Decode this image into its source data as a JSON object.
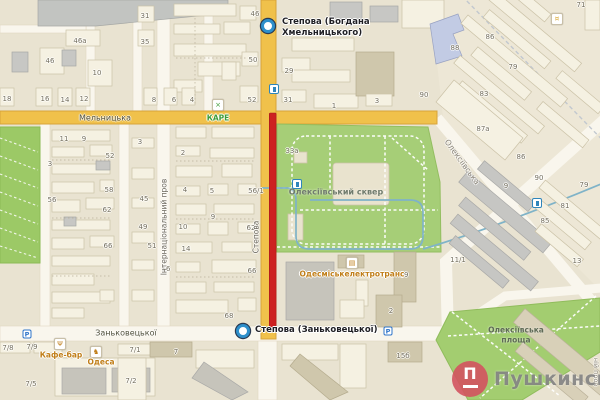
{
  "map": {
    "width": 600,
    "height": 400
  },
  "markers": {
    "top": {
      "label_line1": "Степова (Богдана",
      "label_line2": "Хмельницького)",
      "x": 268,
      "y": 26
    },
    "bottom": {
      "label": "Степова (Заньковецької)",
      "x": 243,
      "y": 331
    }
  },
  "street_labels": [
    {
      "text": "Мельницька",
      "x": 105,
      "y": 118,
      "rot": 0,
      "size": 8,
      "color": "#50503C"
    },
    {
      "text": "Заньковецької",
      "x": 126,
      "y": 333,
      "rot": 0,
      "size": 8,
      "color": "#50503C"
    },
    {
      "text": "Степова",
      "x": 256,
      "y": 237,
      "rot": -90,
      "size": 7.5,
      "color": "#6B675C"
    },
    {
      "text": "Інтернаціональний пров",
      "x": 164,
      "y": 227,
      "rot": -90,
      "size": 7.5,
      "color": "#6B675C"
    },
    {
      "text": "Олексіївська",
      "x": 462,
      "y": 162,
      "rot": 54,
      "size": 8,
      "color": "#8A8478"
    },
    {
      "text": "ній пров",
      "x": 596,
      "y": 372,
      "rot": 90,
      "size": 6.5,
      "color": "#8A8478"
    }
  ],
  "area_labels": [
    {
      "text": "Олексіївський сквер",
      "x": 336,
      "y": 192,
      "size": 8,
      "color": "#6F7B6C"
    },
    {
      "text": "Олексіївська",
      "x": 516,
      "y": 330,
      "size": 7.5,
      "color": "#5E6A55"
    },
    {
      "text": "площа",
      "x": 516,
      "y": 340,
      "size": 7.5,
      "color": "#5E6A55"
    }
  ],
  "pois": [
    {
      "label": "КАРЕ",
      "x": 218,
      "y": 118,
      "icon": "kare",
      "icon_x": 218,
      "icon_y": 105,
      "color": "#3E9C38"
    },
    {
      "label": "Кафе-бар",
      "x": 61,
      "y": 355,
      "icon": "fork",
      "icon_x": 60,
      "icon_y": 344,
      "color": "#C07E18"
    },
    {
      "label": "Одеса",
      "x": 101,
      "y": 362,
      "icon": "horse",
      "icon_x": 96,
      "icon_y": 352,
      "color": "#C07E18"
    },
    {
      "label": "Одесміськелектротранс",
      "x": 352,
      "y": 274,
      "icon": "building",
      "icon_x": 352,
      "icon_y": 263,
      "color": "#C07E18"
    },
    {
      "label": "",
      "x": 557,
      "y": 19,
      "icon": "shop",
      "icon_x": 557,
      "icon_y": 19,
      "color": "#D9A62E"
    }
  ],
  "house_numbers": [
    [
      "46а",
      80,
      41
    ],
    [
      "46",
      50,
      61
    ],
    [
      "10",
      97,
      73
    ],
    [
      "31",
      145,
      16
    ],
    [
      "35",
      145,
      42
    ],
    [
      "18",
      7,
      99
    ],
    [
      "16",
      45,
      99
    ],
    [
      "14",
      65,
      100
    ],
    [
      "12",
      84,
      99
    ],
    [
      "46",
      255,
      14
    ],
    [
      "50",
      253,
      60
    ],
    [
      "8",
      154,
      100
    ],
    [
      "6",
      174,
      100
    ],
    [
      "4",
      192,
      100
    ],
    [
      "52",
      252,
      100
    ],
    [
      "29",
      289,
      71
    ],
    [
      "31",
      288,
      100
    ],
    [
      "1",
      334,
      106
    ],
    [
      "3",
      377,
      101
    ],
    [
      "88",
      455,
      48
    ],
    [
      "86",
      490,
      37
    ],
    [
      "79",
      513,
      67
    ],
    [
      "83",
      484,
      94
    ],
    [
      "90",
      424,
      95
    ],
    [
      "71",
      581,
      5
    ],
    [
      "11",
      64,
      139
    ],
    [
      "9",
      84,
      139
    ],
    [
      "3",
      50,
      164
    ],
    [
      "52",
      110,
      156
    ],
    [
      "58",
      109,
      190
    ],
    [
      "56",
      52,
      200
    ],
    [
      "62",
      107,
      210
    ],
    [
      "66",
      108,
      246
    ],
    [
      "3",
      140,
      142
    ],
    [
      "45",
      144,
      199
    ],
    [
      "49",
      143,
      227
    ],
    [
      "51",
      152,
      246
    ],
    [
      "2",
      183,
      153
    ],
    [
      "4",
      185,
      190
    ],
    [
      "5",
      212,
      191
    ],
    [
      "9",
      213,
      217
    ],
    [
      "10",
      183,
      227
    ],
    [
      "14",
      186,
      249
    ],
    [
      "16",
      166,
      269
    ],
    [
      "62",
      251,
      228
    ],
    [
      "66",
      252,
      271
    ],
    [
      "56/1",
      256,
      191
    ],
    [
      "68",
      229,
      316
    ],
    [
      "33а",
      292,
      151
    ],
    [
      "87а",
      483,
      129
    ],
    [
      "86",
      521,
      157
    ],
    [
      "90",
      539,
      178
    ],
    [
      "9",
      506,
      186
    ],
    [
      "79",
      584,
      185
    ],
    [
      "81",
      565,
      206
    ],
    [
      "85",
      545,
      221
    ],
    [
      "19",
      404,
      275
    ],
    [
      "2",
      391,
      311
    ],
    [
      "11/1",
      458,
      260
    ],
    [
      "13",
      577,
      261
    ],
    [
      "15б",
      403,
      356
    ],
    [
      "7/8",
      8,
      348
    ],
    [
      "7/9",
      32,
      347
    ],
    [
      "7/5",
      31,
      384
    ],
    [
      "7/1",
      135,
      350
    ],
    [
      "7/2",
      131,
      381
    ],
    [
      "7",
      176,
      352
    ]
  ],
  "transit_stops": [
    {
      "x": 274,
      "y": 89
    },
    {
      "x": 297,
      "y": 184
    },
    {
      "x": 537,
      "y": 203
    }
  ],
  "parking": [
    {
      "x": 27,
      "y": 334
    },
    {
      "x": 388,
      "y": 331
    }
  ],
  "brand": {
    "letter": "П",
    "name": "Пушкинская"
  },
  "colors": {
    "road_major": "#F0C14B",
    "closure_red": "#CD2121",
    "park_green": "#A6CE77",
    "strip_green": "#9CC966",
    "plaza_green": "#A3CD70",
    "tram_blue": "#7FB3C8",
    "marker_ring": "#2D8FCB",
    "poi_orange": "#C07E18",
    "poi_green": "#3E9C38",
    "brand_red": "#D3535F"
  }
}
